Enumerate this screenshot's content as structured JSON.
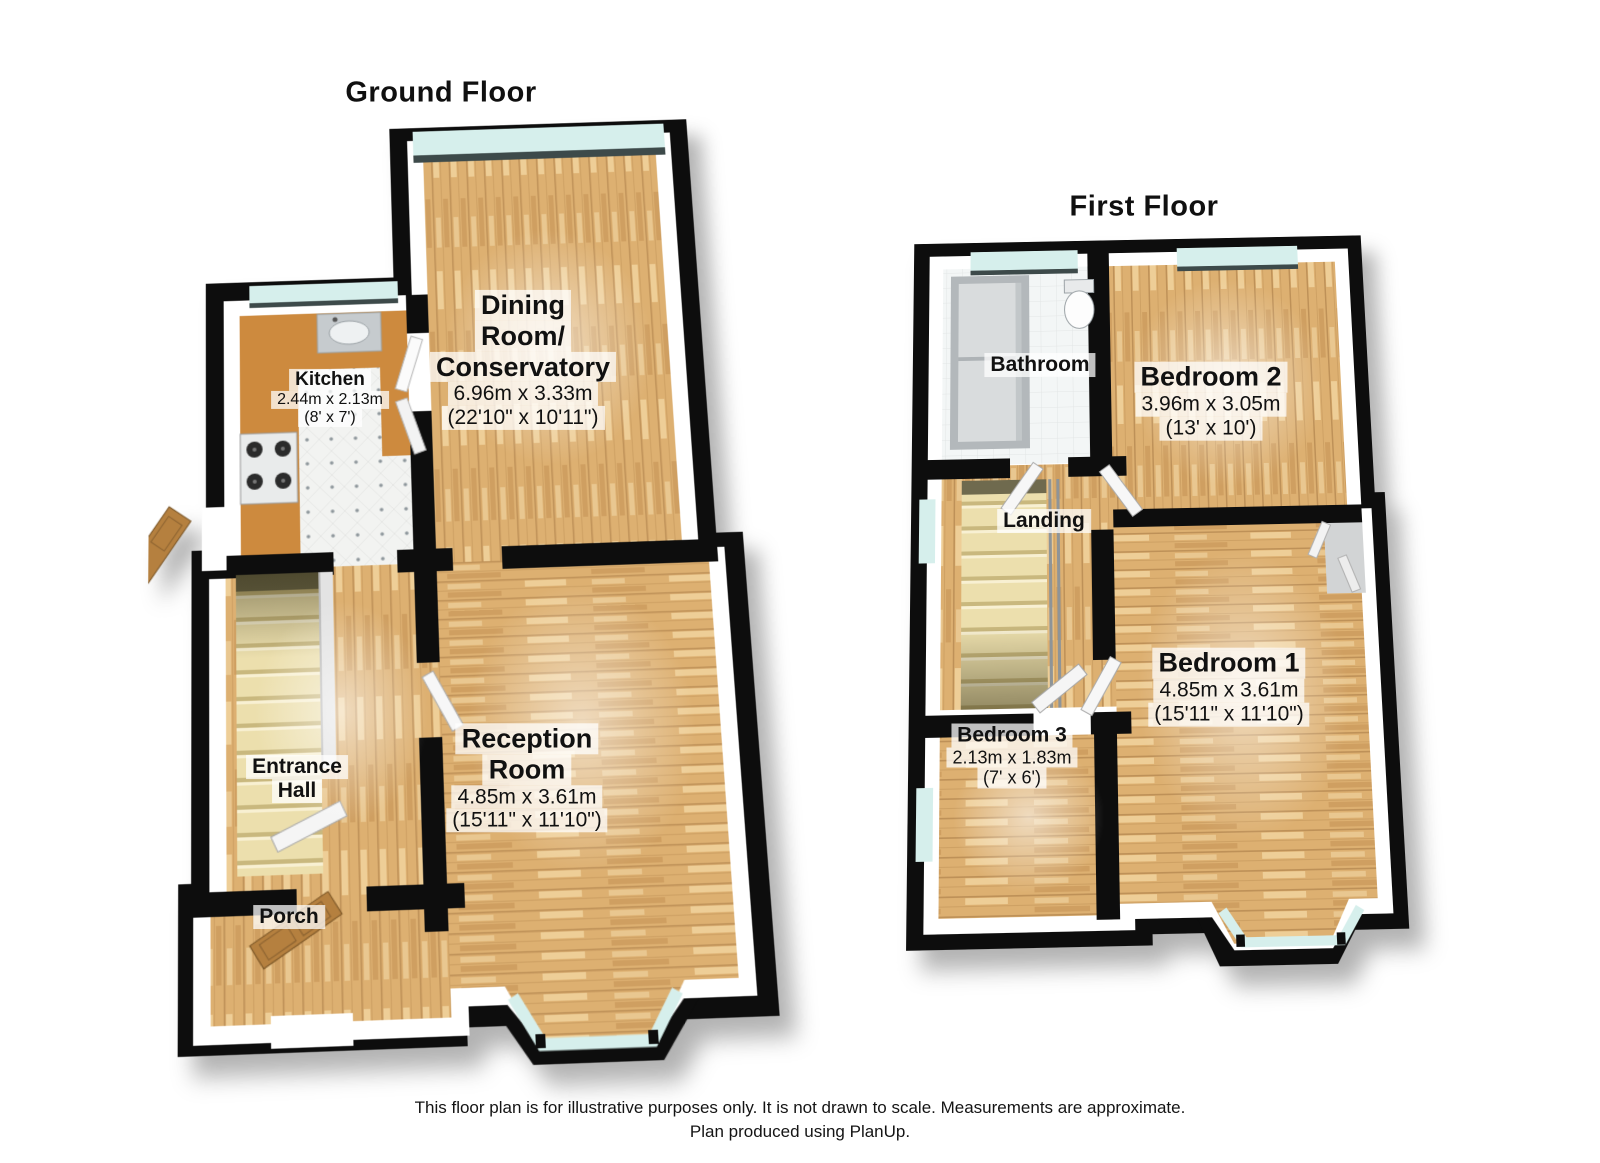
{
  "page": {
    "background": "#ffffff"
  },
  "titles": {
    "ground": "Ground Floor",
    "first": "First Floor"
  },
  "footer": {
    "line1": "This floor plan is for illustrative purposes only. It is not drawn to scale. Measurements are approximate.",
    "line2": "Plan produced using PlanUp."
  },
  "colors": {
    "wall": "#0d0d0d",
    "wall_face": "#ffffff",
    "wood_floor": "#ddb071",
    "kitchen_counter": "#cd8a3e",
    "kitchen_tile": "#f2f3f1",
    "bath_tile": "#f3f6f6",
    "window_glass": "#d6efec",
    "window_sill": "#3d4a4a",
    "stair_tread": "#ecdfad",
    "wood_door": "#b5803f",
    "label_bg": "#ffffff"
  },
  "ground_floor": {
    "rooms": {
      "dining": {
        "lines": [
          "Dining",
          "Room/",
          "Conservatory"
        ],
        "metric": "6.96m x 3.33m",
        "imperial": "(22'10\" x 10'11\")"
      },
      "kitchen": {
        "lines": [
          "Kitchen"
        ],
        "metric": "2.44m x 2.13m",
        "imperial": "(8' x 7')"
      },
      "reception": {
        "lines": [
          "Reception",
          "Room"
        ],
        "metric": "4.85m x 3.61m",
        "imperial": "(15'11\" x 11'10\")"
      },
      "entrance_hall": {
        "lines": [
          "Entrance",
          "Hall"
        ]
      },
      "porch": {
        "lines": [
          "Porch"
        ]
      }
    }
  },
  "first_floor": {
    "rooms": {
      "bathroom": {
        "lines": [
          "Bathroom"
        ]
      },
      "bedroom2": {
        "lines": [
          "Bedroom 2"
        ],
        "metric": "3.96m x 3.05m",
        "imperial": "(13' x 10')"
      },
      "landing": {
        "lines": [
          "Landing"
        ]
      },
      "bedroom1": {
        "lines": [
          "Bedroom 1"
        ],
        "metric": "4.85m x 3.61m",
        "imperial": "(15'11\" x 11'10\")"
      },
      "bedroom3": {
        "lines": [
          "Bedroom 3"
        ],
        "metric": "2.13m x 1.83m",
        "imperial": "(7' x 6')"
      }
    }
  }
}
